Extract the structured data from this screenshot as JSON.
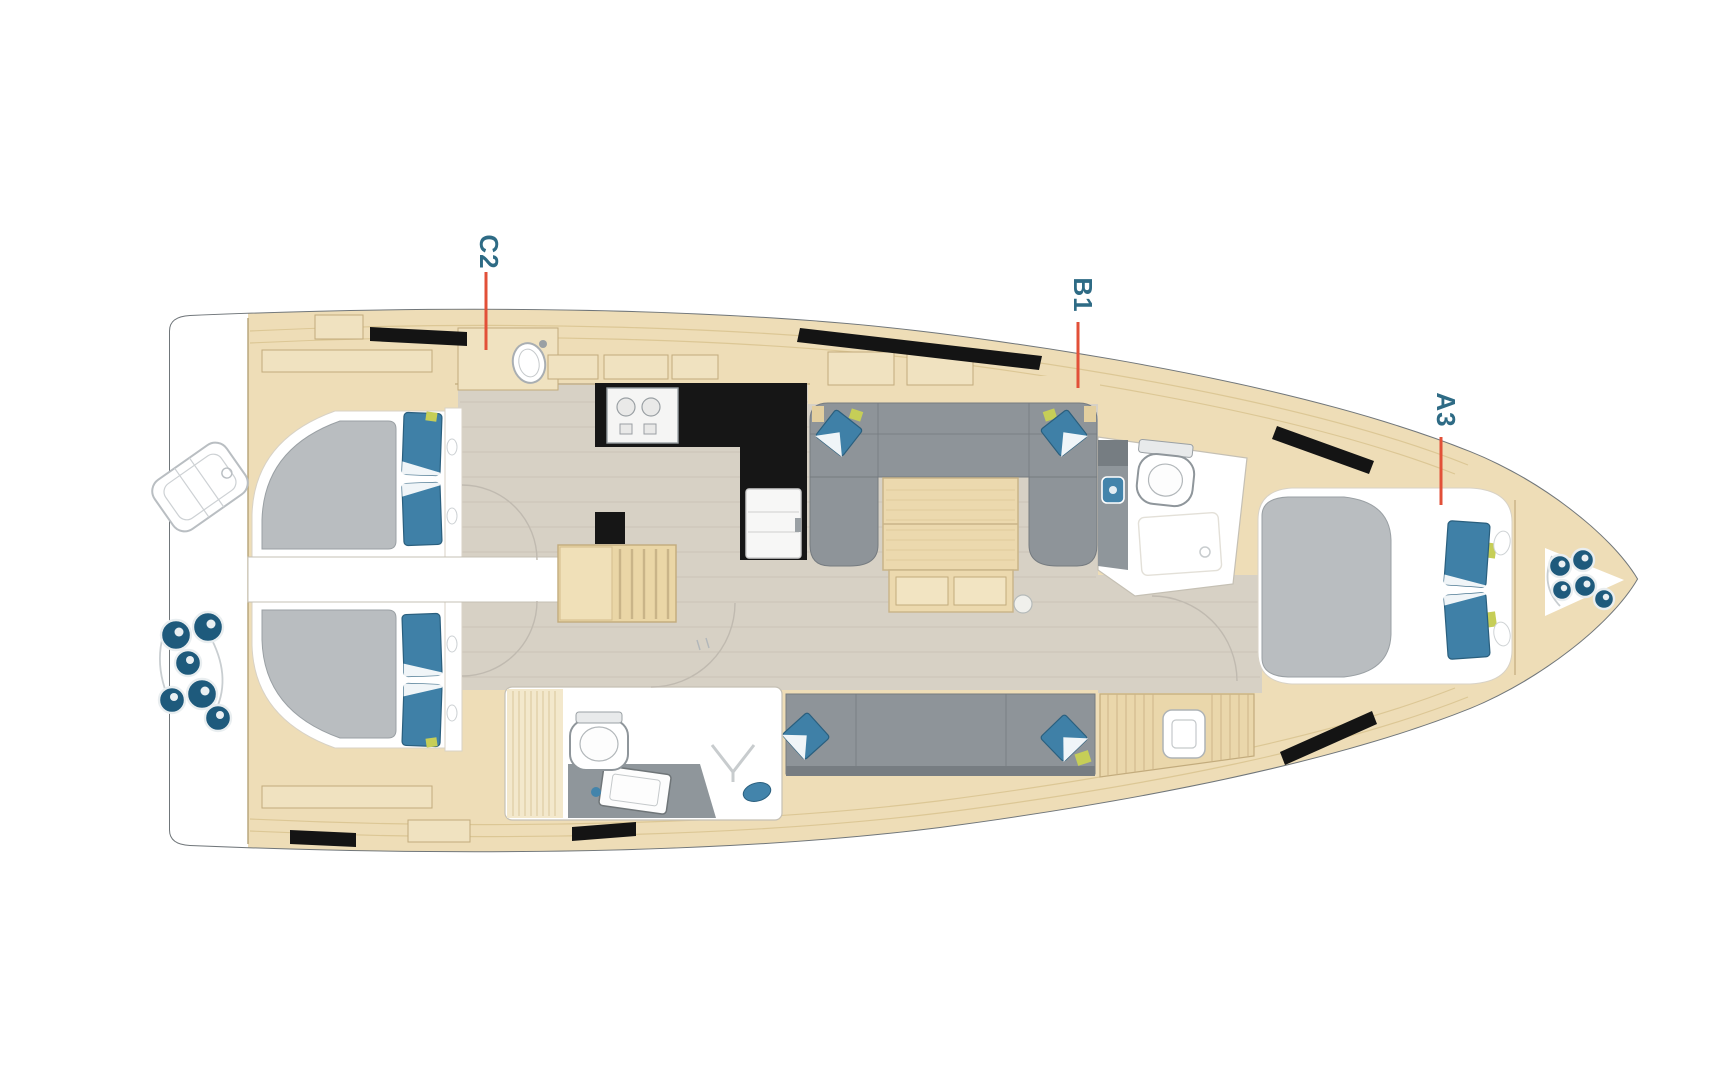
{
  "diagram": {
    "type": "sailing-yacht-interior-layout-plan",
    "orientation": "bow-right",
    "cabin_labels": [
      {
        "id": "C2"
      },
      {
        "id": "B1"
      },
      {
        "id": "A3"
      }
    ],
    "fixtures": [
      "aft-double-berth-port",
      "aft-double-berth-starboard",
      "forward-v-berth",
      "galley-stove",
      "fridge",
      "galley-sink",
      "saloon-u-sofa",
      "saloon-table",
      "saloon-settee",
      "companionway-stairs",
      "aft-head-toilet",
      "aft-head-sink",
      "aft-head-shower",
      "forward-head-toilet",
      "forward-head-sink",
      "nav-cabinet",
      "liferaft",
      "stern-fenders",
      "bow-fenders",
      "hull-windows"
    ],
    "colors": {
      "wood": "#eeddb7",
      "wood2": "#f0e2c0",
      "wood_line": "#c2ab7c",
      "wood_seam": "#dcc795",
      "floor": "#d7d1c5",
      "floor_line": "#c2bbac",
      "upholstery": "#8e9499",
      "upholstery_line": "#757b80",
      "mattress": "#b9bdc0",
      "mattress_line": "#9aa0a4",
      "platform_line": "#d8d2c6",
      "pillow": "#3f80a7",
      "pillow_line": "#2a5f7e",
      "counter": "#161616",
      "fixture_gray": "#8f969b",
      "fender": "#1e5a7c",
      "window": "#141414",
      "hull_line": "#70767a",
      "hull_line_light": "#9aa0a4",
      "wall_line": "#c5c0b4",
      "door_arc": "#c0bab0",
      "accent_green": "#c6ce57",
      "label": "#2e6b85",
      "marker": "#e25038"
    }
  }
}
